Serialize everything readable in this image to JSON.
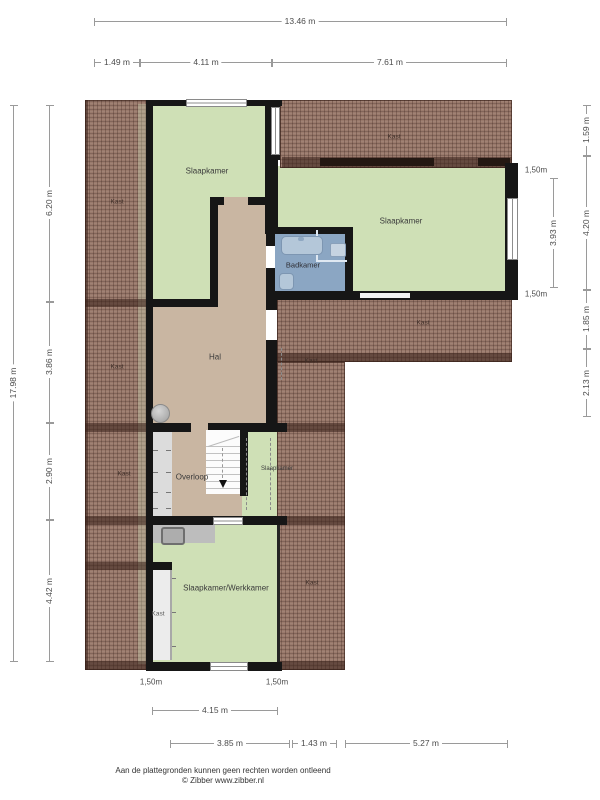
{
  "rooms": {
    "slaapkamer1": "Slaapkamer",
    "slaapkamer2": "Slaapkamer",
    "slaapkamer3": "Slaapkamer",
    "badkamer": "Badkamer",
    "hal": "Hal",
    "overloop": "Overloop",
    "werkkamer": "Slaapkamer/Werkkamer"
  },
  "kast": [
    "Kast",
    "Kast",
    "Kast",
    "Kast",
    "Kast",
    "Kast",
    "Kast",
    "Kast"
  ],
  "dims": {
    "total_width": "13.46 m",
    "top_segments": [
      "1.49 m",
      "4.11 m",
      "7.61 m"
    ],
    "left_total": "17.98 m",
    "left_segments": [
      "6.20 m",
      "3.86 m",
      "2.90 m",
      "4.42 m"
    ],
    "right_segments": [
      "1.59 m",
      "4.20 m",
      "1.85 m",
      "2.13 m"
    ],
    "right_inner": {
      "top": "1,50m",
      "middle": "3.93 m",
      "bottom": "1,50m"
    },
    "bottom_clearances": [
      "1,50m",
      "1,50m"
    ],
    "bottom_upper": "4.15 m",
    "bottom_segments": [
      "3.85 m",
      "1.43 m",
      "5.27 m"
    ]
  },
  "footer": {
    "disclaimer": "Aan de plattegronden kunnen geen rechten worden ontleend",
    "credit": "© Zibber www.zibber.nl"
  },
  "colors": {
    "room_green": "#cfe0b6",
    "hall_tan": "#c9b6a2",
    "bath_blue": "#8ba6c3",
    "roof_brown": "#9a7a6c",
    "wall_black": "#161616",
    "dim_gray": "#9a9a9a"
  }
}
